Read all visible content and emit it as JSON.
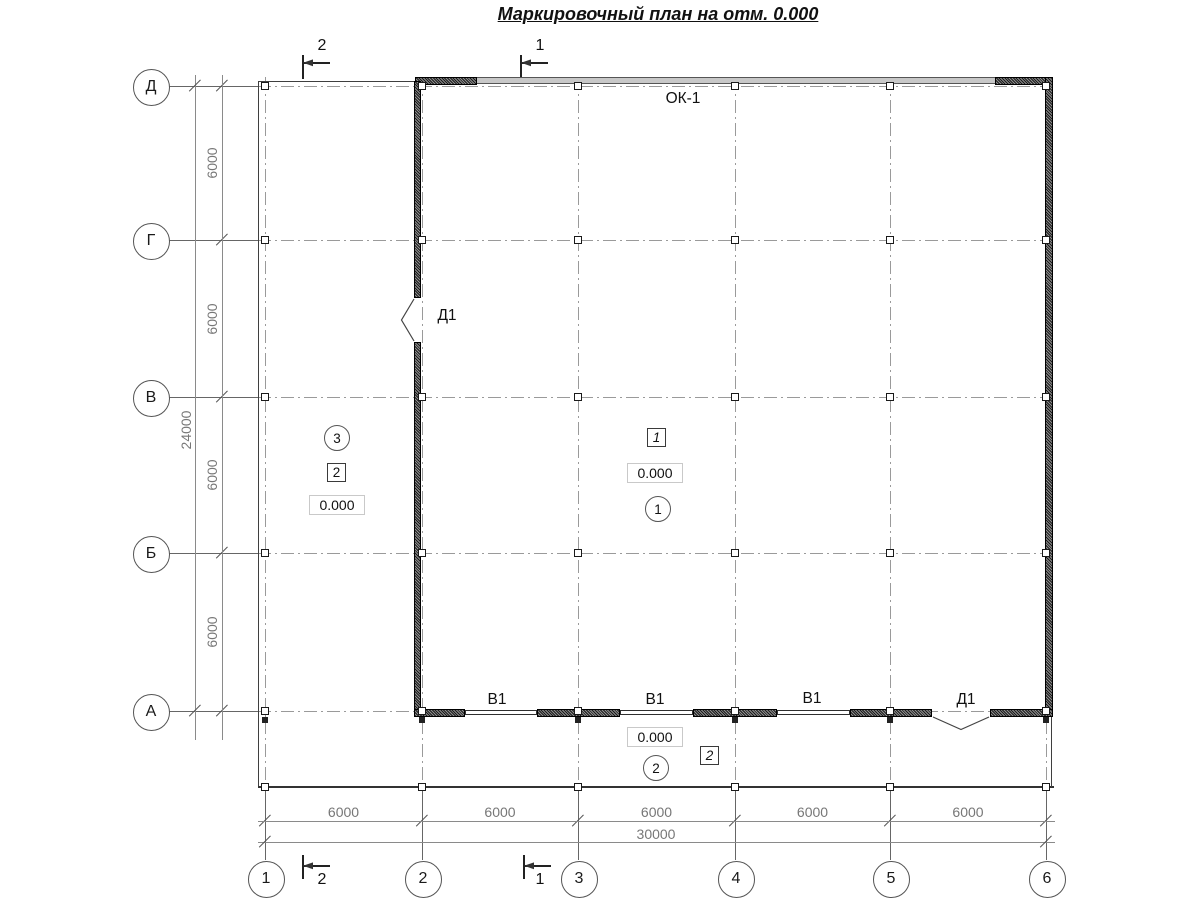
{
  "title": "Маркировочный план на отм. 0.000",
  "axes": {
    "letters": [
      "Д",
      "Г",
      "В",
      "Б",
      "А"
    ],
    "numbers": [
      "1",
      "2",
      "3",
      "4",
      "5",
      "6"
    ]
  },
  "dimensions": {
    "left_spans": [
      "6000",
      "6000",
      "6000",
      "6000"
    ],
    "left_total": "24000",
    "bottom_spans": [
      "6000",
      "6000",
      "6000",
      "6000",
      "6000"
    ],
    "bottom_total": "30000"
  },
  "sections": {
    "top": [
      "2",
      "1"
    ],
    "bottom": [
      "2",
      "1"
    ]
  },
  "marks": {
    "window_label": "ОК-1",
    "door_label_wall": "Д1",
    "door_label_bottom": "Д1",
    "gate_labels": [
      "В1",
      "В1",
      "В1"
    ],
    "levels": {
      "left": "0.000",
      "center": "0.000",
      "bottom": "0.000"
    },
    "room_circles": {
      "left": "3",
      "center": "1",
      "bottom": "2"
    },
    "ref_squares": {
      "left": "2",
      "center": "1",
      "bottom": "2"
    }
  },
  "colors": {
    "line": "#3f3f3f",
    "dimension": "#8a8a8a",
    "grid": "#9a9a9a",
    "wall": "#1b1b1b",
    "window_band": "#c8c8c8"
  }
}
